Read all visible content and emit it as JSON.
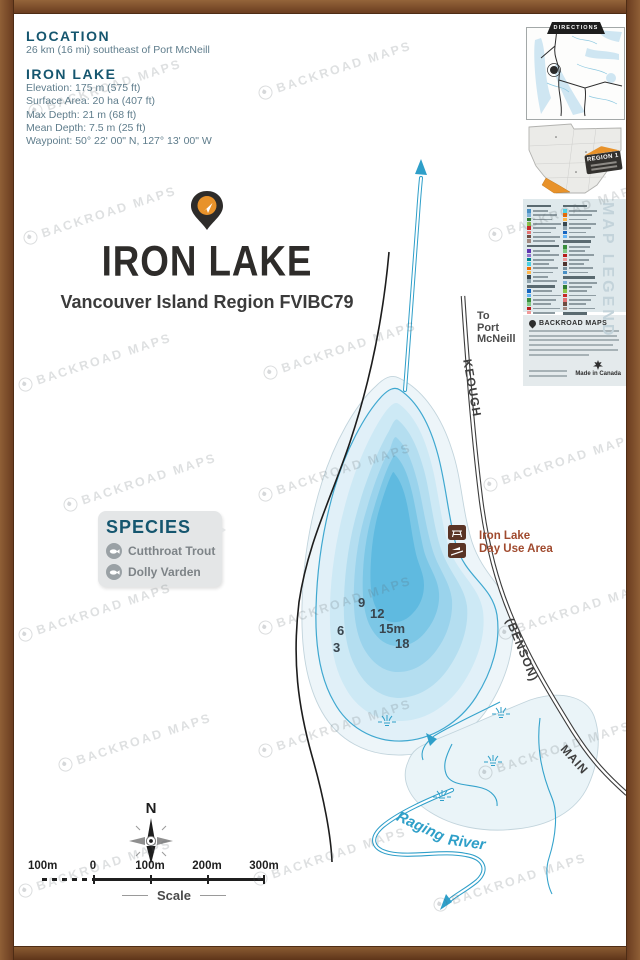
{
  "info": {
    "location_heading": "LOCATION",
    "location_text": "26 km (16 mi) southeast of Port McNeill",
    "lake_heading": "IRON LAKE",
    "stats": [
      "Elevation: 175 m (575 ft)",
      "Surface Area: 20 ha (407 ft)",
      "Max Depth: 21 m (68 ft)",
      "Mean Depth: 7.5 m (25 ft)",
      "Waypoint: 50° 22' 00\" N, 127° 13' 00\" W"
    ]
  },
  "title": {
    "name": "IRON LAKE",
    "subtitle": "Vancouver Island Region FVIBC79"
  },
  "sidebar": {
    "directions_label": "DIRECTIONS",
    "region_badge": "REGION 1",
    "map_legend_label": "MAP LEGEND",
    "brand": "BACKROAD MAPS",
    "made_in": "Made in Canada"
  },
  "map": {
    "to_port": [
      "To",
      "Port",
      "McNeill"
    ],
    "roads": [
      "KEOUGH",
      "(BENSON)",
      "MAIN"
    ],
    "river": [
      "Raging",
      "River"
    ],
    "day_use": [
      "Iron Lake",
      "Day Use Area"
    ],
    "depths": [
      "9",
      "12",
      "6",
      "3",
      "15m",
      "18"
    ],
    "species": {
      "heading": "SPECIES",
      "items": [
        "Cutthroat Trout",
        "Dolly Varden"
      ]
    },
    "compass": "N",
    "scale_labels": [
      "100m",
      "0",
      "100m",
      "200m",
      "300m"
    ],
    "scale_caption": "Scale"
  },
  "watermark": "BACKROAD MAPS",
  "colors": {
    "accent_orange": "#e8922a",
    "heading_teal": "#15566f",
    "lake_deep": "#5fbae0",
    "lake_light": "#e1f0f8",
    "day_use_brown": "#5a3425",
    "frame_wood": "#7a4a28"
  }
}
